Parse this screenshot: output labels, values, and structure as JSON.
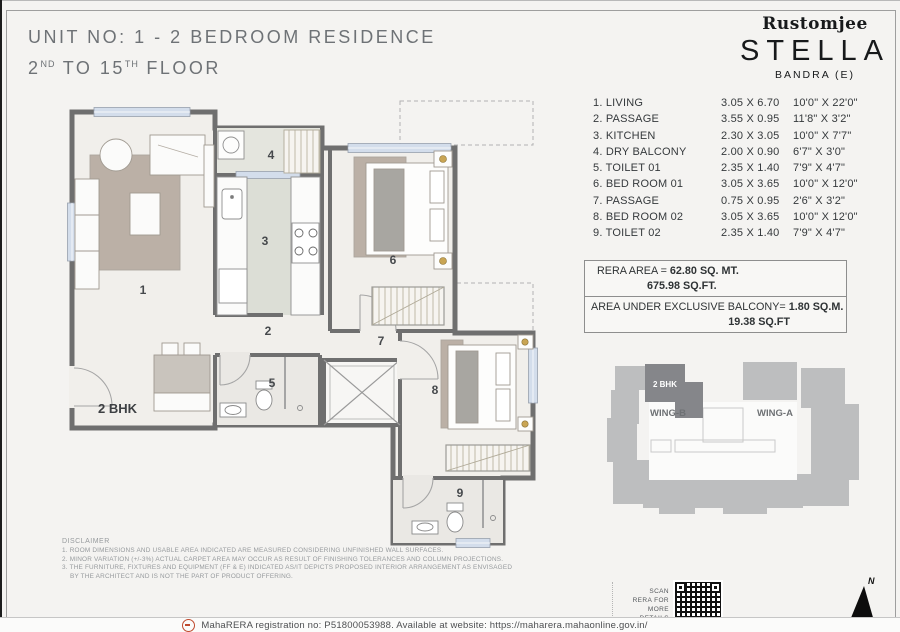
{
  "header": {
    "title_line1": "UNIT NO: 1 - 2 BEDROOM RESIDENCE",
    "floor_prefix": "2",
    "floor_sup1": "ND",
    "floor_mid": " TO 15",
    "floor_sup2": "TH",
    "floor_suffix": " FLOOR"
  },
  "logo": {
    "brand": "Rustomjee",
    "project": "STELLA",
    "location": "BANDRA (E)"
  },
  "dimensions_table": {
    "rows": [
      {
        "label": "1. LIVING",
        "metric": "3.05 X 6.70",
        "imperial": "10'0\" X 22'0\""
      },
      {
        "label": "2. PASSAGE",
        "metric": "3.55 X 0.95",
        "imperial": "11'8\" X 3'2\""
      },
      {
        "label": "3. KITCHEN",
        "metric": "2.30 X 3.05",
        "imperial": "10'0\" X 7'7\""
      },
      {
        "label": "4. DRY BALCONY",
        "metric": "2.00 X 0.90",
        "imperial": "6'7\" X 3'0\""
      },
      {
        "label": "5. TOILET 01",
        "metric": "2.35 X 1.40",
        "imperial": "7'9\" X 4'7\""
      },
      {
        "label": "6. BED ROOM 01",
        "metric": "3.05 X 3.65",
        "imperial": "10'0\" X 12'0\""
      },
      {
        "label": "7. PASSAGE",
        "metric": "0.75 X 0.95",
        "imperial": "2'6\" X 3'2\""
      },
      {
        "label": "8. BED ROOM 02",
        "metric": "3.05 X 3.65",
        "imperial": "10'0\" X 12'0\""
      },
      {
        "label": "9. TOILET 02",
        "metric": "2.35 X 1.40",
        "imperial": "7'9\" X 4'7\""
      }
    ]
  },
  "rera": {
    "area_label": "RERA AREA = ",
    "area_sqmt": "62.80 SQ. MT.",
    "area_sqft": "675.98 SQ.FT.",
    "balcony_label": "AREA UNDER EXCLUSIVE BALCONY= ",
    "balcony_sqm": "1.80 SQ.M.",
    "balcony_sqft": "19.38 SQ.FT"
  },
  "floor_plan": {
    "unit_type_label": "2 BHK",
    "room_numbers": [
      "1",
      "2",
      "3",
      "4",
      "5",
      "6",
      "7",
      "8",
      "9"
    ]
  },
  "key_plan": {
    "unit_label": "2 BHK",
    "wing_b_label": "WING-B",
    "wing_a_label": "WING-A"
  },
  "scan_block": {
    "lines": [
      "SCAN",
      "RERA FOR",
      "MORE",
      "DETAILS"
    ]
  },
  "compass": {
    "north_label": "N"
  },
  "disclaimer": {
    "title": "DISCLAIMER",
    "lines": [
      "1. ROOM DIMENSIONS AND USABLE AREA INDICATED ARE MEASURED CONSIDERING UNFINISHED WALL SURFACES.",
      "2. MINOR VARIATION (+/-3%) ACTUAL CARPET AREA MAY OCCUR AS RESULT OF FINISHING TOLERANCES AND COLUMN PROJECTIONS.",
      "3. THE FURNITURE, FIXTURES AND EQUIPMENT (FF & E) INDICATED AS/IT DEPICTS PROPOSED INTERIOR ARRANGEMENT AS ENVISAGED",
      "BY THE ARCHITECT AND IS NOT THE PART OF PRODUCT OFFERING."
    ]
  },
  "footer": {
    "rera_registration": "MahaRERA registration no: P51800053988. Available at website: https://maharera.mahaonline.gov.in/"
  },
  "colors": {
    "wall_gray": "#6f6f6f",
    "accent_red": "#bf4a2e",
    "key_plan_light": "#bdbebf",
    "key_plan_dark": "#85868a",
    "window_blue": "#d3ddeb"
  }
}
